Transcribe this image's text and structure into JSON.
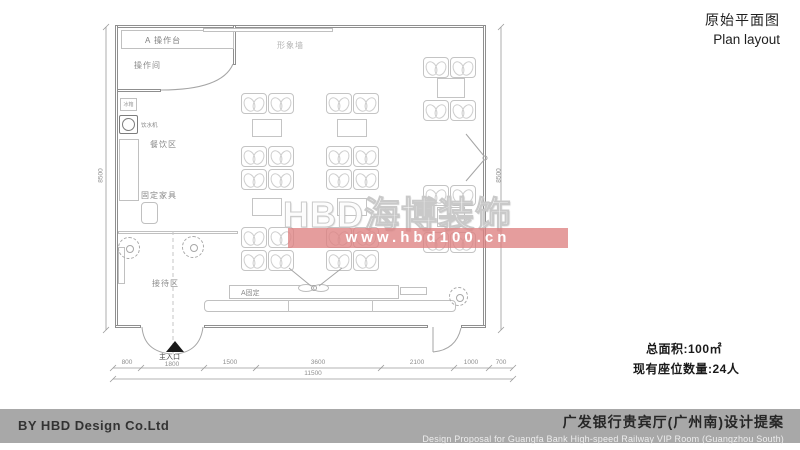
{
  "header": {
    "title_cn": "原始平面图",
    "title_en": "Plan layout"
  },
  "stats": {
    "total_area": "总面积:100㎡",
    "seat_count": "现有座位数量:24人"
  },
  "footer": {
    "credit": "BY HBD Design Co.Ltd",
    "project_cn": "广发银行贵宾厅(广州南)设计提案",
    "project_en": "Design Proposal for Guangfa Bank High-speed Railway VIP Room (Guangzhou South)"
  },
  "watermark": {
    "brand": "HBD海博装饰",
    "url": "www.hbd100.cn"
  },
  "colors": {
    "watermark_band": "#DE8282",
    "footer_bar": "#A8A8A8"
  },
  "plan": {
    "labels": {
      "counter_a": "A 操作台",
      "operation_room": "操作间",
      "fridge": "冰箱",
      "water_dispenser": "饮水机",
      "dining_area": "餐饮区",
      "fixed_furniture": "固定家具",
      "reception_area": "接待区",
      "image_wall": "形象墙",
      "fixed_a": "A固定",
      "main_entrance": "主入口"
    },
    "dimensions": {
      "bottom_segments": [
        "800",
        "1800",
        "1500",
        "3600",
        "2100",
        "1000",
        "700"
      ],
      "bottom_total": "11500",
      "left_height": "8500",
      "right_height": "8500"
    }
  }
}
